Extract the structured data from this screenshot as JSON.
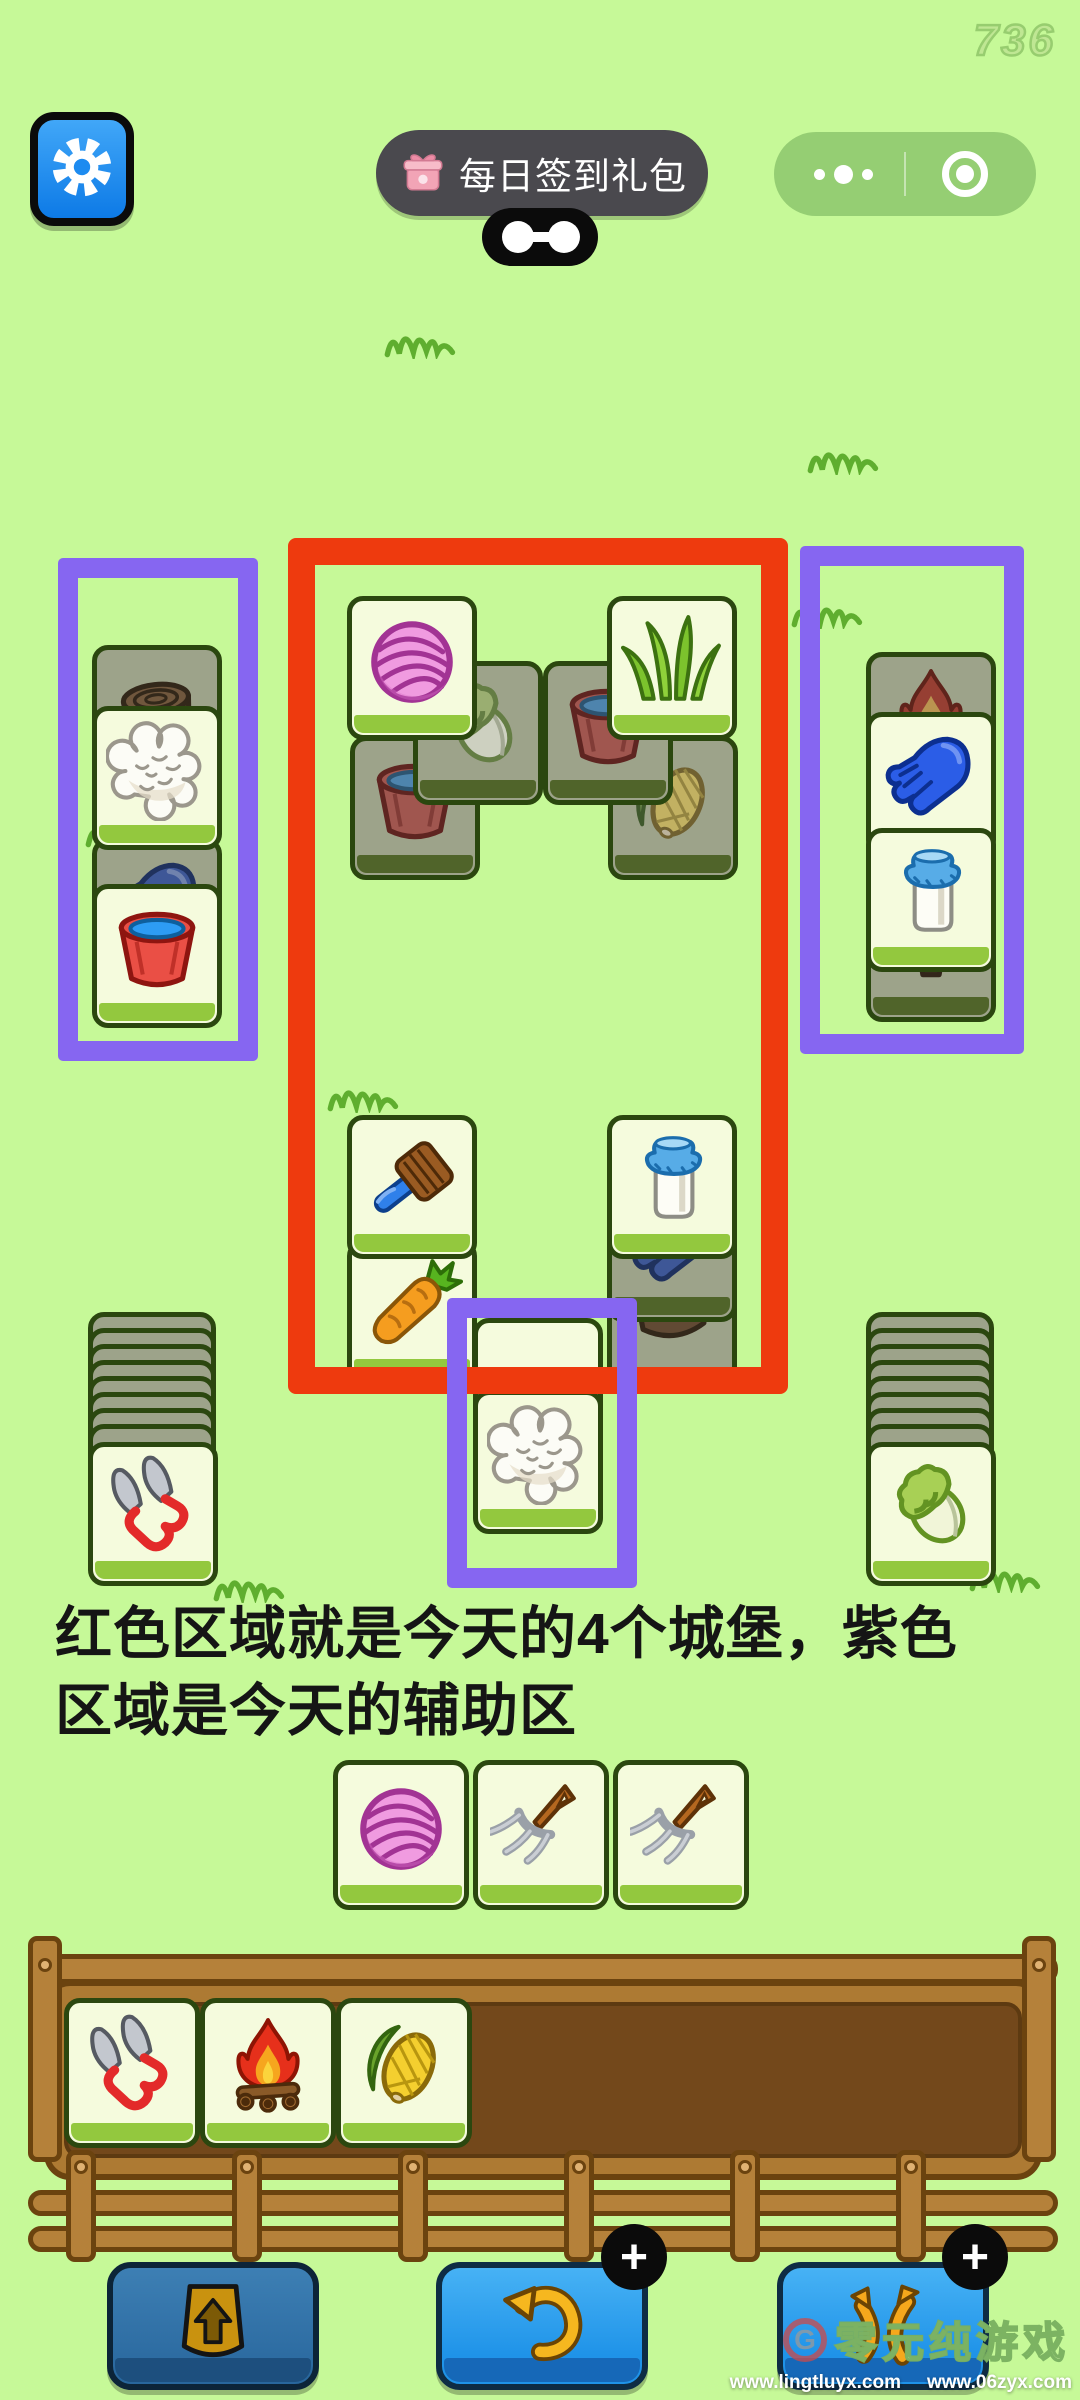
{
  "status": {
    "counter": "736"
  },
  "header": {
    "settings_button": {
      "icon": "gear"
    },
    "daily_signin_button": {
      "icon": "gift",
      "label": "每日签到礼包"
    },
    "bone_toggle": {
      "icon": "bone"
    },
    "wechat_capsule": {
      "more_icon": "ellipsis",
      "close_icon": "circle-dot"
    }
  },
  "board": {
    "castle_frame_color": "#ee3a0e",
    "assist_frame_color": "#8666f1",
    "castle": {
      "top_tiles": [
        {
          "icon": "yarn",
          "state": "open"
        },
        {
          "icon": "grass",
          "state": "open"
        },
        {
          "icon": "cabbage",
          "state": "covered"
        },
        {
          "icon": "bucket",
          "state": "covered"
        },
        {
          "icon": "bucket",
          "state": "covered"
        },
        {
          "icon": "corn",
          "state": "covered"
        }
      ],
      "bottom_left_tiles": [
        {
          "icon": "brush",
          "state": "open"
        },
        {
          "icon": "carrot",
          "state": "open"
        }
      ],
      "bottom_right_tiles": [
        {
          "icon": "milk",
          "state": "open"
        },
        {
          "icon": "glove",
          "state": "covered"
        },
        {
          "icon": "log",
          "state": "covered"
        }
      ]
    },
    "assist_left": {
      "tiles": [
        {
          "icon": "log",
          "state": "covered"
        },
        {
          "icon": "cotton",
          "state": "open"
        },
        {
          "icon": "glove",
          "state": "covered"
        },
        {
          "icon": "bucket",
          "state": "open"
        }
      ]
    },
    "assist_right": {
      "tiles": [
        {
          "icon": "campfire",
          "state": "covered"
        },
        {
          "icon": "glove",
          "state": "open"
        },
        {
          "icon": "milk",
          "state": "open"
        },
        {
          "icon": "stump",
          "state": "covered"
        }
      ]
    },
    "assist_bottom": {
      "tiles": [
        {
          "icon": null,
          "state": "open"
        },
        {
          "icon": "cotton",
          "state": "open"
        }
      ]
    },
    "stack_left": {
      "hidden_count": 8,
      "front_tile": {
        "icon": "shears",
        "state": "open"
      }
    },
    "stack_right": {
      "hidden_count": 8,
      "front_tile": {
        "icon": "cabbage",
        "state": "open"
      }
    },
    "free_row": {
      "tiles": [
        {
          "icon": "yarn",
          "state": "open"
        },
        {
          "icon": "pitchfork",
          "state": "open"
        },
        {
          "icon": "pitchfork",
          "state": "open"
        }
      ]
    }
  },
  "annotation": {
    "line1": "红色区域就是今天的4个城堡，紫色",
    "line2": "区域是今天的辅助区"
  },
  "tray": {
    "tiles": [
      {
        "icon": "shears",
        "state": "open"
      },
      {
        "icon": "campfire",
        "state": "open"
      },
      {
        "icon": "corn",
        "state": "open"
      }
    ]
  },
  "footer_buttons": [
    {
      "name": "eject",
      "icon": "eject",
      "enabled": false,
      "badge": ""
    },
    {
      "name": "undo",
      "icon": "undo",
      "enabled": true,
      "badge": "+"
    },
    {
      "name": "shuffle",
      "icon": "shuffle",
      "enabled": true,
      "badge": "+"
    }
  ],
  "watermark": {
    "logo_letter": "G",
    "brand": "零元纯游戏",
    "urls": [
      "www.lingtluyx.com",
      "www.06zyx.com"
    ]
  }
}
